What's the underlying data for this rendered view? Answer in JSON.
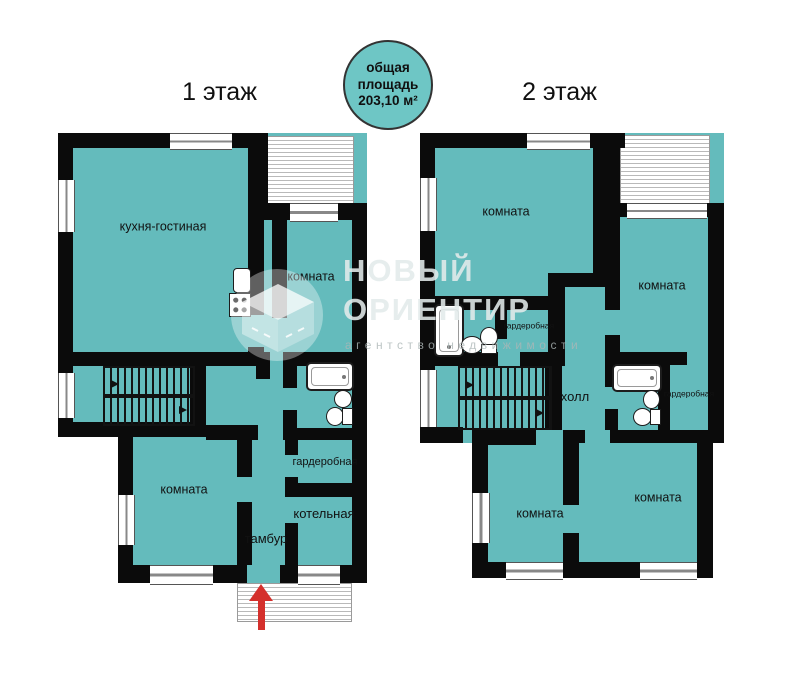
{
  "header": {
    "floor1_title": "1 этаж",
    "floor2_title": "2 этаж",
    "area_badge": {
      "line1": "общая",
      "line2": "площадь",
      "line3": "203,10 м²"
    }
  },
  "floor1": {
    "rooms": {
      "kitchen_living": "кухня-гостиная",
      "room_top": "комната",
      "room_bottom": "комната",
      "wardrobe": "гардеробная",
      "boiler": "котельная",
      "vestibule": "тамбур"
    }
  },
  "floor2": {
    "rooms": {
      "room_top_left": "комната",
      "room_top_right": "комната",
      "room_bottom_left": "комната",
      "room_bottom_right": "комната",
      "hall": "холл",
      "wardrobe_small": "гардеробная",
      "wardrobe_right": "гардеробная"
    }
  },
  "watermark": {
    "line1": "НОВЫЙ",
    "line2": "ОРИЕНТИР",
    "subtitle": "агентство недвижимости"
  },
  "colors": {
    "room_fill": "#64bbbc",
    "wall": "#0b0b0b",
    "badge_fill": "#6ec6c5",
    "entrance_arrow": "#d4302c"
  }
}
